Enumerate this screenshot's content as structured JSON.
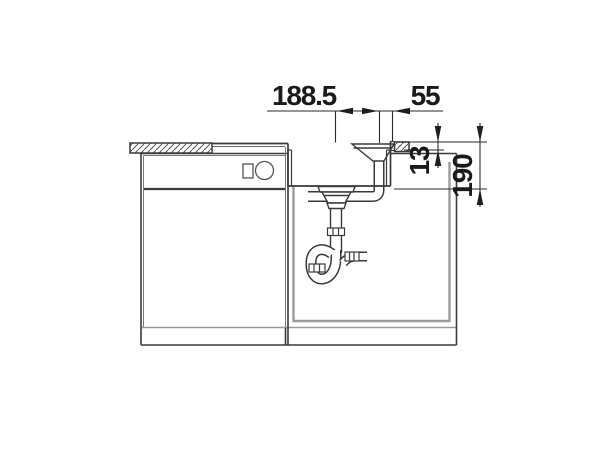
{
  "drawing": {
    "type": "technical-installation-drawing",
    "subject": "kitchen sink front section with base cabinet, drain strainer, overflow pipe and trap",
    "dimensions": {
      "horizontal_main": "188.5",
      "horizontal_right": "55",
      "vertical_small": "13",
      "vertical_depth": "190"
    },
    "colors": {
      "line": "#3a3a3a",
      "thin_line": "#6a6a6a",
      "dimension": "#2a2a2a",
      "niche_gray": "#9b9b9b",
      "background": "#ffffff"
    }
  }
}
